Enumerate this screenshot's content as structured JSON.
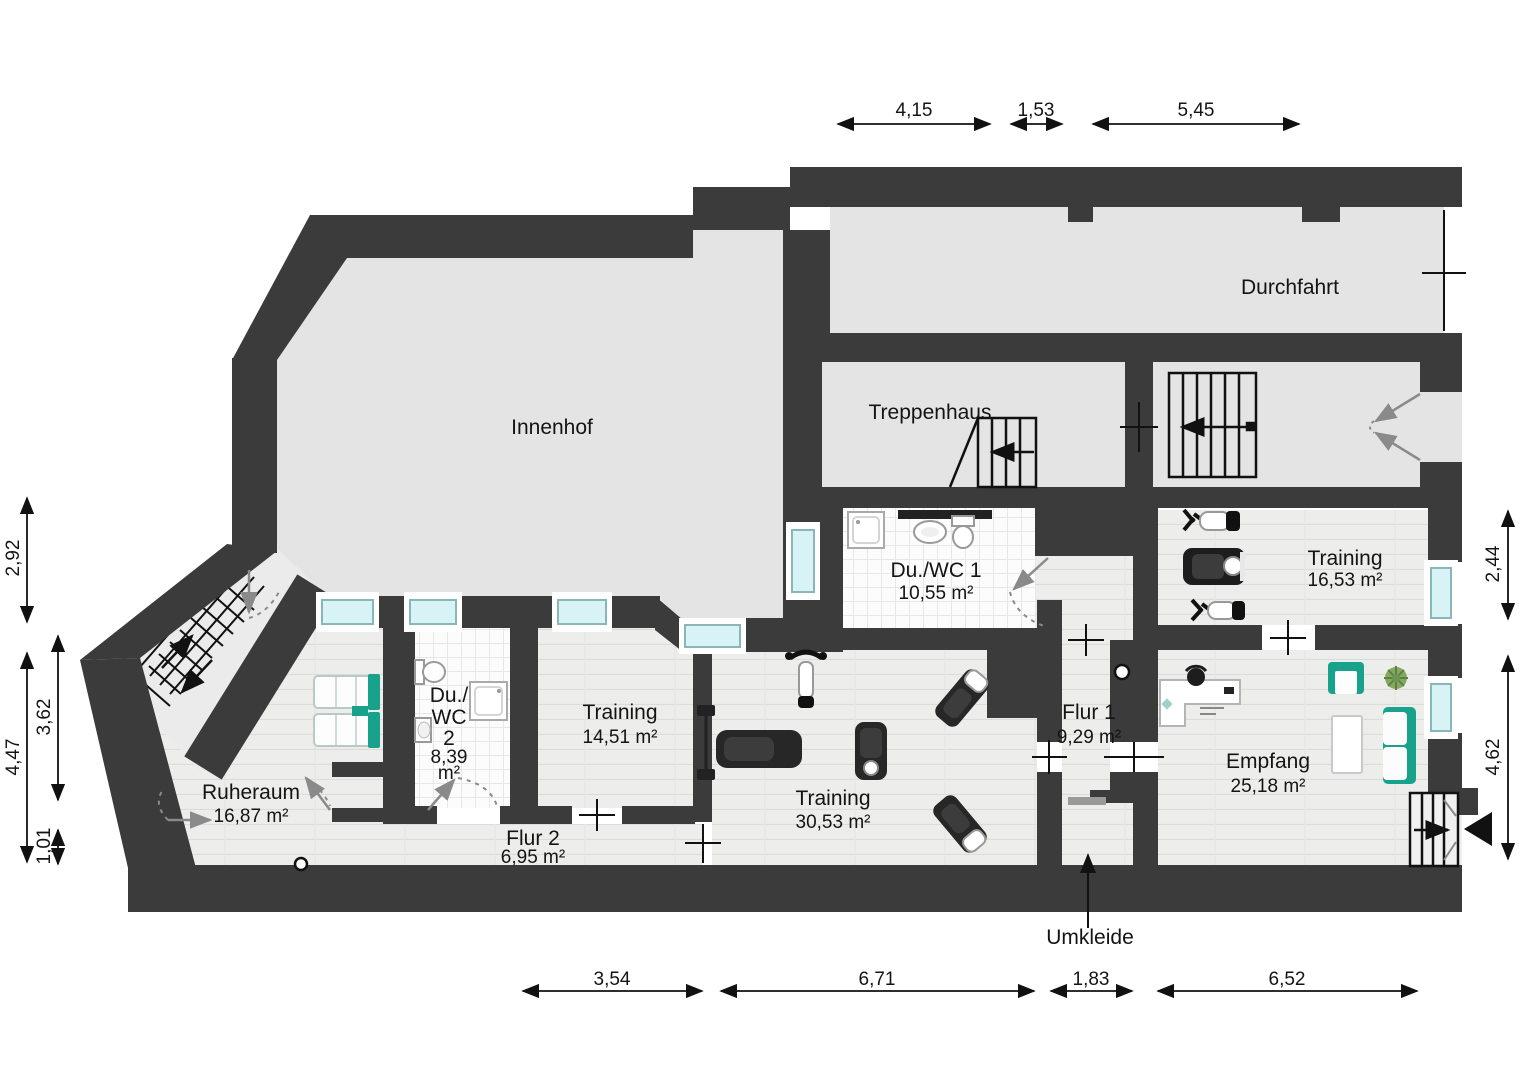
{
  "plan": {
    "type": "floor-plan",
    "language": "de",
    "rooms": {
      "innenhof": {
        "name": "Innenhof"
      },
      "durchfahrt": {
        "name": "Durchfahrt"
      },
      "treppenhaus": {
        "name": "Treppenhaus"
      },
      "du_wc_1": {
        "name": "Du./WC 1",
        "area": "10,55 m²"
      },
      "training_right": {
        "name": "Training",
        "area": "16,53 m²"
      },
      "empfang": {
        "name": "Empfang",
        "area": "25,18 m²"
      },
      "flur_1": {
        "name": "Flur 1",
        "area": "9,29 m²"
      },
      "umkleide": {
        "name": "Umkleide"
      },
      "training_center": {
        "name": "Training",
        "area": "30,53 m²"
      },
      "training_left": {
        "name": "Training",
        "area": "14,51 m²"
      },
      "du_wc_2": {
        "line1": "Du./",
        "line2": "WC",
        "line3": "2",
        "area_value": "8,39",
        "area_unit": "m²"
      },
      "flur_2": {
        "name": "Flur 2",
        "area": "6,95 m²"
      },
      "ruheraum": {
        "name": "Ruheraum",
        "area": "16,87 m²"
      }
    },
    "dimensions": {
      "top": {
        "d1": "4,15",
        "d2": "1,53",
        "d3": "5,45"
      },
      "left": {
        "d1": "2,92",
        "d2": "4,47",
        "d3": "3,62",
        "d4": "1,01"
      },
      "right": {
        "d1": "2,44",
        "d2": "4,62"
      },
      "bottom": {
        "d1": "3,54",
        "d2": "6,71",
        "d3": "1,83",
        "d4": "6,52"
      }
    },
    "colors": {
      "wall": "#3b3b3b",
      "courtyard": "#e4e4e4",
      "window_glass": "#d8f3f5",
      "accent_teal": "#18a28b"
    }
  }
}
